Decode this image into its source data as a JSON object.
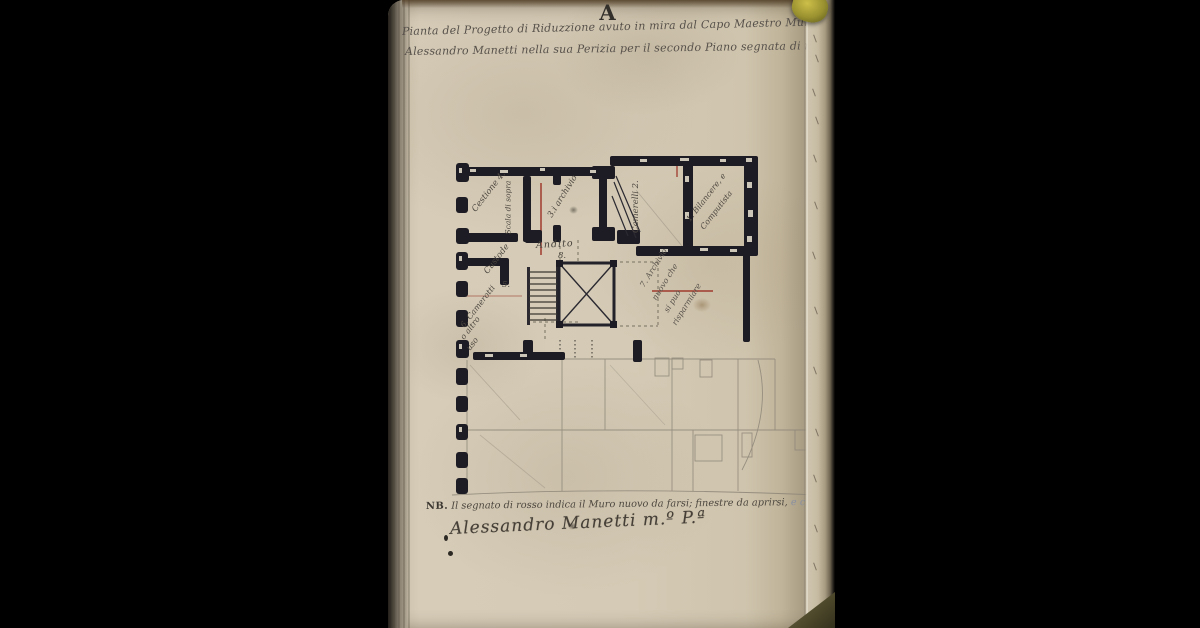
{
  "colors": {
    "background": "#000000",
    "paper": "#d2c8b2",
    "wall_ink": "#1d1c24",
    "handwriting_ink": "#56504a",
    "red_mark": "#a03a2c",
    "pencil": "#8d8578",
    "clasp_brass": "#9a9130"
  },
  "page": {
    "section_letter": "A",
    "header_line1": "Pianta del Progetto di Riduzzione avuto in mira dal Capo Maestro Mur.e",
    "header_line2": "Alessandro Manetti nella sua Perizia per il secondo Piano segnata di n.º 71",
    "plan_labels": {
      "room4": "Cestione 4.",
      "corridor": "Scala di sopra",
      "room3": "3.i archivio",
      "room2": "Camerelli 2.",
      "room1a": "1. Bilancere, e",
      "room1b": "Computista",
      "andito": "Andito",
      "andito_num": "8.",
      "room5": "Custode",
      "room5_num": "5.",
      "room6a": "6. Camerotti",
      "room6b": "o altro",
      "room6c": "uso",
      "room7a": "7. Archivio",
      "room7b": "nuovo che",
      "room7c": "si può",
      "room7d": "risparmiare"
    },
    "note": {
      "prefix": "NB.",
      "text": " Il segnato di rosso indica il Muro nuovo da farsi; finestre da aprirsi, ",
      "tail": "e c..."
    },
    "signature": "Alessandro Manetti m.º P.ª"
  }
}
